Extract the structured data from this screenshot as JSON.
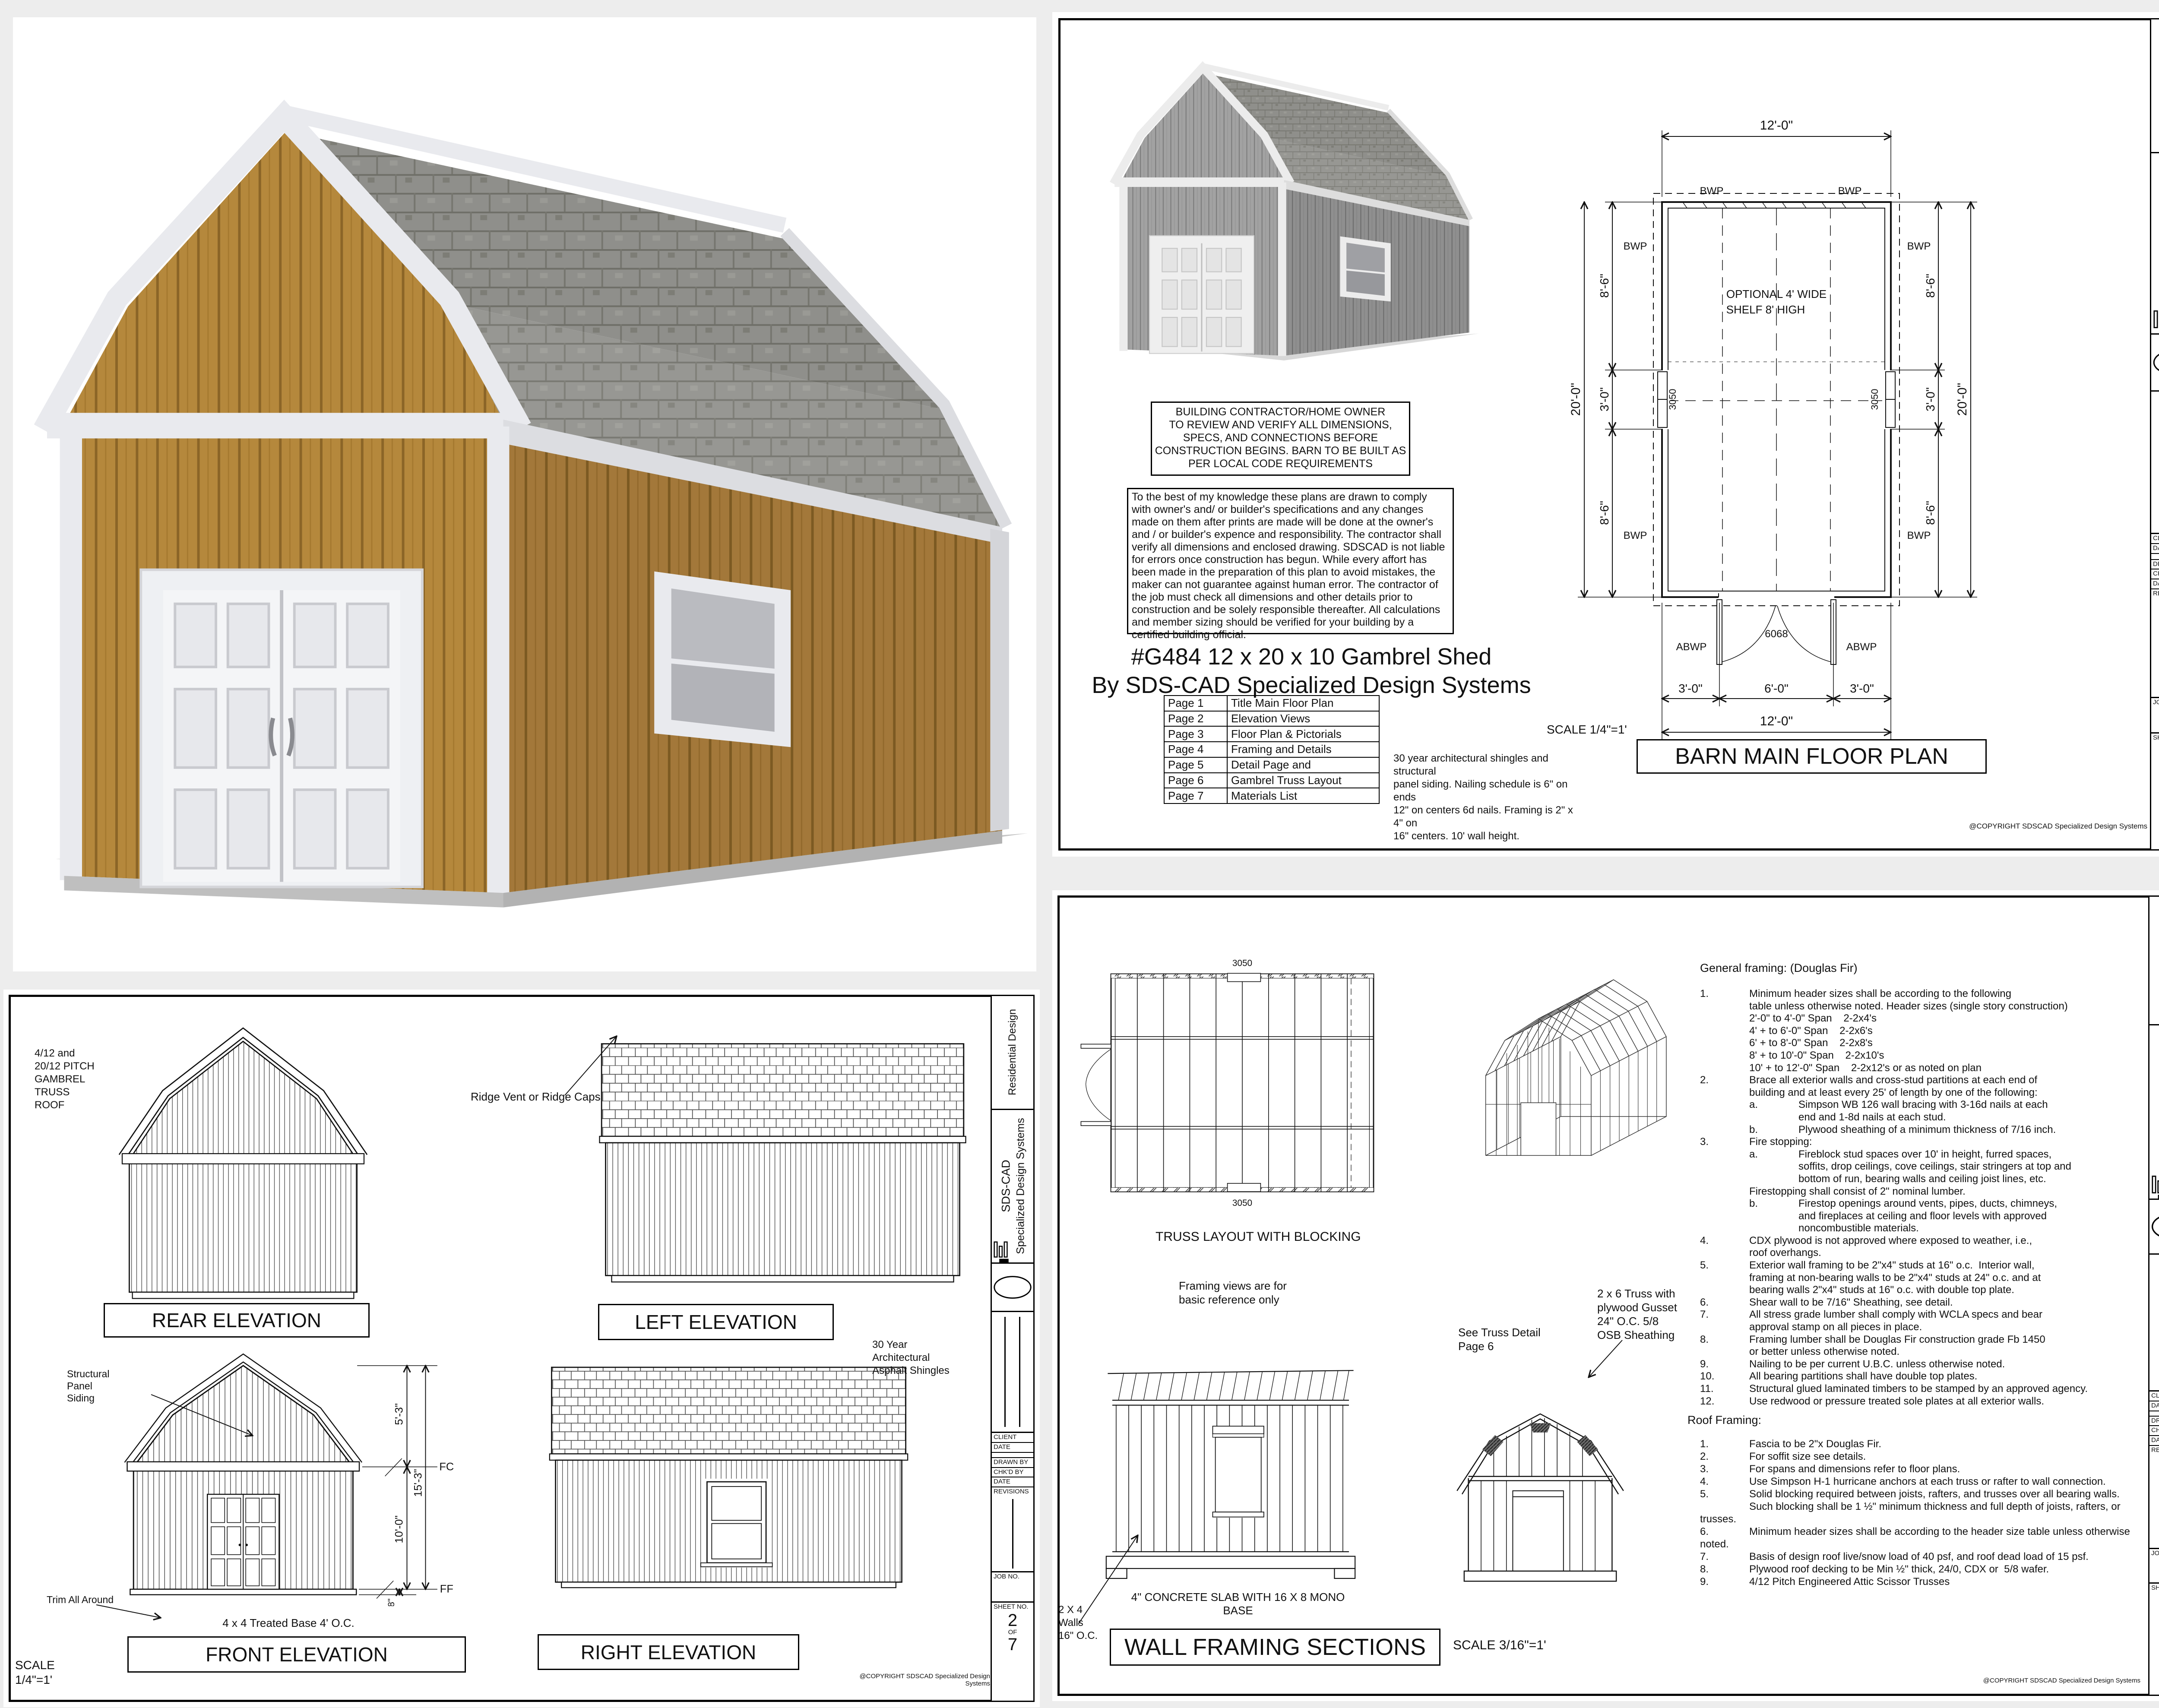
{
  "titleblock": {
    "residential": "Residential Design",
    "brand1": "SDS-CAD",
    "brand2": "Specialized Design Systems",
    "f_client": "CLIENT",
    "f_date": "DATE",
    "f_drawn": "DRAWN BY",
    "f_chkd": "CHK'D BY",
    "f_date2": "DATE",
    "f_rev": "REVISIONS",
    "f_job": "JOB NO.",
    "f_sheet": "SHEET NO.",
    "of": "OF",
    "total": "7"
  },
  "sheet1": {
    "sheet_no": "1",
    "contractor_note": "BUILDING CONTRACTOR/HOME OWNER\nTO REVIEW AND VERIFY ALL DIMENSIONS,\nSPECS, AND CONNECTIONS BEFORE\nCONSTRUCTION BEGINS. BARN TO BE BUILT AS\nPER LOCAL CODE REQUIREMENTS",
    "disclaimer": "To the best of my knowledge these plans are drawn to comply with owner's and/ or builder's specifications and any changes made on them after prints are made will be done at the owner's and / or builder's expence and responsibility. The contractor shall verify all dimensions and enclosed drawing.  SDSCAD is not liable for errors once construction has begun. While every affort has been made in the preparation of this plan to avoid mistakes, the maker can not guarantee against human error. The contractor of the job must check all dimensions and other details prior to construction and be solely responsible thereafter.  All calculations and member sizing should be verified for your building by a certified building official.",
    "title_line1": "#G484 12 x 20 x 10 Gambrel Shed",
    "title_line2": "By SDS-CAD Specialized Design Systems",
    "page_index": [
      {
        "page": "Page 1",
        "title": "Title Main Floor Plan"
      },
      {
        "page": "Page 2",
        "title": "Elevation Views"
      },
      {
        "page": "Page 3",
        "title": "Floor Plan & Pictorials"
      },
      {
        "page": "Page 4",
        "title": "Framing and Details"
      },
      {
        "page": "Page 5",
        "title": "Detail Page and"
      },
      {
        "page": "Page 6",
        "title": "Gambrel Truss Layout"
      },
      {
        "page": "Page 7",
        "title": "Materials List"
      }
    ],
    "shingle_note": "30 year architectural shingles and structural\npanel siding.  Nailing schedule is 6\" on ends\n12\" on centers 6d nails.  Framing is 2\" x 4\" on\n16\" centers.  10' wall height.",
    "scale": "SCALE 1/4\"=1'",
    "drawing_title": "BARN MAIN FLOOR PLAN",
    "plan": {
      "dim_top": "12'-0\"",
      "dim_bottom": "12'-0\"",
      "dim_overall": "20'-0\"",
      "seg_86": "8'-6\"",
      "seg_30": "3'-0\"",
      "door_3": "3'-0\"",
      "door_6": "6'-0\"",
      "door_code": "6068",
      "win_code": "3050",
      "bwp": "BWP",
      "abwp": "ABWP",
      "shelf1": "OPTIONAL 4' WIDE",
      "shelf2": "SHELF 8' HIGH"
    },
    "copyright": "@COPYRIGHT SDSCAD Specialized Design Systems"
  },
  "sheet2": {
    "sheet_no": "2",
    "roof_note": "4/12 and\n20/12 PITCH\nGAMBREL\nTRUSS\nROOF",
    "ridge_note": "Ridge Vent or Ridge Caps",
    "rear_label": "REAR ELEVATION",
    "left_label": "LEFT ELEVATION",
    "front_label": "FRONT ELEVATION",
    "right_label": "RIGHT ELEVATION",
    "shingles_note": "30 Year\nArchitectural\nAsphalt Shingles",
    "siding_note": "EXTERIOR\nSTRUCTURAL\nPANEL T1-11\nSIDING",
    "walls_note": "10' Tall 2 x 4\nWalls",
    "structural_note": "Structural\nPanel\nSiding",
    "trim_note": "Trim All Around",
    "base_note": "4 x 4 Treated Base 4' O.C.",
    "scale": "SCALE\n1/4\"=1'",
    "d53": "5'-3\"",
    "d153": "15'-3\"",
    "d100": "10'-0\"",
    "d8": "8\"",
    "fc": "FC",
    "ff": "FF",
    "copyright": "@COPYRIGHT SDSCAD Specialized Design Systems"
  },
  "sheet3": {
    "sheet_no": "4",
    "truss_label": "TRUSS LAYOUT WITH BLOCKING",
    "dim3050": "3050",
    "framing_note": "Framing views are for\nbasic reference only",
    "general_heading": "General framing:  (Douglas Fir)",
    "general_notes": "1.\tMinimum header sizes shall be according to the following\n\ttable unless otherwise noted. Header sizes (single story construction)\n\t2'-0\" to 4'-0\" Span    2-2x4's\n\t4' + to 6'-0\" Span    2-2x6's\n\t6' + to 8'-0\" Span    2-2x8's\n\t8' + to 10'-0\" Span    2-2x10's\n\t10' + to 12'-0\" Span    2-2x12's or as noted on plan\n2.\tBrace all exterior walls and cross-stud partitions at each end of\n\tbuilding and at least every 25' of length by one of the following:\n\ta.\tSimpson WB 126 wall bracing with 3-16d nails at each\n\t\tend and 1-8d nails at each stud.\n\tb.\tPlywood sheathing of a minimum thickness of 7/16 inch.\n3.\tFire stopping:\n\ta.\tFireblock stud spaces over 10' in height, furred spaces,\n\t\tsoffits, drop ceilings, cove ceilings, stair stringers at top and\n\t\tbottom of run, bearing walls and ceiling joist lines, etc.\n\tFirestopping shall consist of 2\" nominal lumber.\n\tb.\tFirestop openings around vents, pipes, ducts, chimneys,\n\t\tand fireplaces at ceiling and floor levels with approved\n\t\tnoncombustible materials.\n4.\tCDX plywood is not approved where exposed to weather, i.e.,\n\troof overhangs.\n5.\tExterior wall framing to be 2\"x4\" studs at 16\" o.c.  Interior wall,\n\tframing at non-bearing walls to be 2\"x4\" studs at 24\" o.c. and at\n\tbearing walls 2\"x4\" studs at 16\" o.c. with double top plate.\n6.\tShear wall to be 7/16\" Sheathing, see detail.\n7.\tAll stress grade lumber shall comply with WCLA specs and bear\n\tapproval stamp on all pieces in place.\n8.\tFraming lumber shall be Douglas Fir construction grade Fb 1450\n\tor better unless otherwise noted.\n9.\tNailing to be per current U.B.C. unless otherwise noted.\n10.\tAll bearing partitions shall have double top plates.\n11.\tStructural glued laminated timbers to be stamped by an approved agency.\n12.\tUse redwood or pressure treated sole plates at all exterior walls.",
    "roof_heading": "Roof Framing:",
    "roof_notes": "1.\tFascia to be 2\"x Douglas Fir.\n2.\tFor soffit size see details.\n3.\tFor spans and dimensions refer to floor plans.\n4.\tUse Simpson H-1 hurricane anchors at each truss or rafter to wall connection.\n5.\tSolid blocking required between joists, rafters, and trusses over all bearing walls.\n\tSuch blocking shall be 1 ½\" minimum thickness and full depth of joists, rafters, or trusses.\n6.\tMinimum header sizes shall be according to the header size table unless otherwise noted.\n7.\tBasis of design roof live/snow load of 40 psf, and roof dead load of 15 psf.\n8.\tPlywood roof decking to be Min ½\" thick, 24/0, CDX or  5/8 wafer.\n9.\t4/12 Pitch Engineered Attic Scissor Trusses",
    "truss_note": "2 x 6 Truss with\nplywood Gusset\n24\" O.C. 5/8\nOSB Sheathing",
    "see_detail": "See Truss Detail\nPage 6",
    "slab_note": "4\" CONCRETE SLAB WITH 16 X 8 MONO BASE",
    "walls_note": "2 X 4\nWalls\n16\" O.C.",
    "section_title": "WALL FRAMING SECTIONS",
    "scale": "SCALE 3/16\"=1'",
    "copyright": "@COPYRIGHT SDSCAD Specialized Design Systems"
  }
}
